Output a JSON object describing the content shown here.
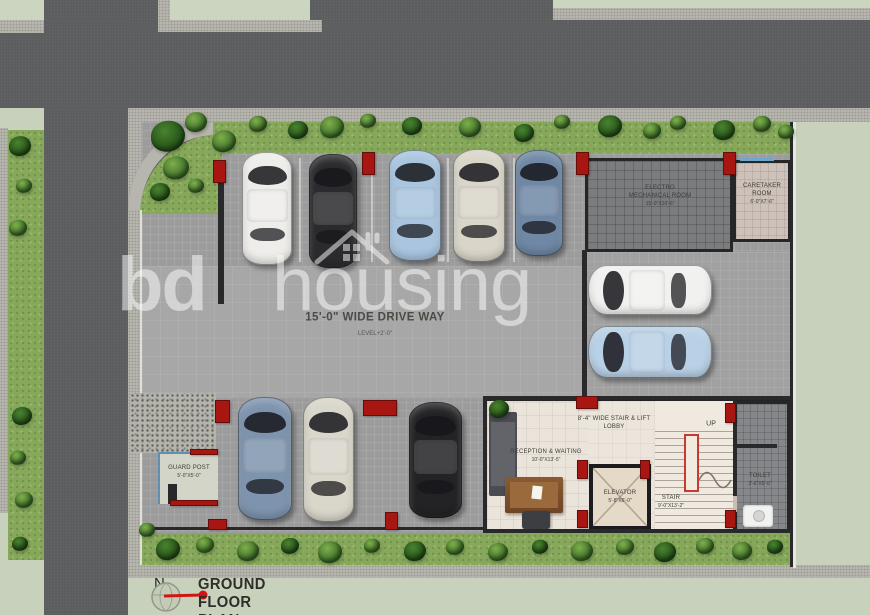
{
  "watermark": {
    "bold": "bd",
    "light": "housing"
  },
  "title_block": {
    "north_letter": "N",
    "title": "GROUND FLOOR PLAN"
  },
  "labels": {
    "driveway": "15'-0\" WIDE DRIVE WAY",
    "driveway_level": "LEVEL+2'-0\"",
    "mech_room": {
      "l1": "ELECTRO",
      "l2": "MECHANICAL ROOM",
      "dim": "15'-0\"X10'-6\""
    },
    "caretaker": {
      "l1": "CARETAKER",
      "l2": "ROOM",
      "dim": "6'-0\"X7'-6\""
    },
    "lobby": {
      "l1": "8'-4\" WIDE STAIR & LIFT",
      "l2": "LOBBY"
    },
    "reception": {
      "l1": "RECEPTION & WAITING",
      "dim": "10'-0\"X13'-5\""
    },
    "elevator": {
      "l1": "ELEVATOR",
      "dim": "5'-8\"X6'-0\""
    },
    "stair": {
      "l1": "STAIR",
      "dim": "9'-0\"X13'-2\""
    },
    "up": "UP",
    "toilet": {
      "l1": "TOILET",
      "dim": "3'-6\"X5'-6\""
    },
    "guard_post": {
      "l1": "GUARD POST",
      "dim": "5'-0\"X5'-0\""
    }
  },
  "colors": {
    "column_red": "#a81612",
    "road": "#5c5d5e",
    "sidewalk": "#b6b6ae",
    "grass": "#87a85b",
    "parking_floor": "#9c9c9d",
    "lobby_floor": "#ece5db",
    "window_blue": "#6fa8cf",
    "north_red": "#d11511"
  },
  "cars": [
    {
      "x": 242,
      "y": 152,
      "w": 50,
      "h": 113,
      "dir": "up",
      "color": "#eeedea"
    },
    {
      "x": 309,
      "y": 154,
      "w": 48,
      "h": 114,
      "dir": "up",
      "color": "#2b2b2e"
    },
    {
      "x": 389,
      "y": 150,
      "w": 52,
      "h": 111,
      "dir": "up",
      "color": "#a9c5df"
    },
    {
      "x": 453,
      "y": 149,
      "w": 52,
      "h": 113,
      "dir": "up",
      "color": "#d9d5c9"
    },
    {
      "x": 515,
      "y": 150,
      "w": 48,
      "h": 106,
      "dir": "up",
      "color": "#6f88a5"
    },
    {
      "x": 588,
      "y": 265,
      "w": 124,
      "h": 50,
      "dir": "left",
      "color": "#f1f1ef"
    },
    {
      "x": 588,
      "y": 326,
      "w": 124,
      "h": 52,
      "dir": "left",
      "color": "#b9d1e6"
    },
    {
      "x": 238,
      "y": 397,
      "w": 54,
      "h": 123,
      "dir": "up",
      "color": "#7e94ae"
    },
    {
      "x": 303,
      "y": 397,
      "w": 51,
      "h": 125,
      "dir": "up",
      "color": "#d9d6ca"
    },
    {
      "x": 409,
      "y": 402,
      "w": 53,
      "h": 116,
      "dir": "up",
      "color": "#232326"
    }
  ],
  "columns": [
    [
      213,
      160,
      13,
      23
    ],
    [
      362,
      152,
      13,
      23
    ],
    [
      576,
      152,
      13,
      23
    ],
    [
      723,
      152,
      13,
      23
    ],
    [
      215,
      400,
      15,
      23
    ],
    [
      363,
      400,
      34,
      16
    ],
    [
      208,
      519,
      19,
      11
    ],
    [
      385,
      512,
      13,
      18
    ],
    [
      576,
      396,
      22,
      13
    ],
    [
      725,
      403,
      11,
      20
    ],
    [
      577,
      460,
      11,
      19
    ],
    [
      640,
      460,
      10,
      19
    ],
    [
      577,
      510,
      11,
      18
    ],
    [
      725,
      510,
      11,
      18
    ],
    [
      190,
      449,
      28,
      6
    ],
    [
      170,
      500,
      48,
      6
    ]
  ],
  "walls": [
    [
      218,
      164,
      6,
      140
    ],
    [
      582,
      250,
      5,
      148
    ],
    [
      483,
      396,
      310,
      4
    ],
    [
      483,
      396,
      4,
      136
    ],
    [
      483,
      529,
      310,
      4
    ],
    [
      733,
      399,
      4,
      133
    ],
    [
      733,
      444,
      44,
      4
    ],
    [
      790,
      122,
      3,
      445
    ],
    [
      168,
      484,
      9,
      20
    ],
    [
      142,
      527,
      344,
      3
    ]
  ],
  "bushes": [
    [
      168,
      136,
      17,
      1
    ],
    [
      196,
      122,
      11,
      0
    ],
    [
      224,
      141,
      12,
      0
    ],
    [
      258,
      124,
      9,
      0
    ],
    [
      298,
      130,
      10,
      1
    ],
    [
      332,
      127,
      12,
      0
    ],
    [
      368,
      121,
      8,
      0
    ],
    [
      412,
      126,
      10,
      1
    ],
    [
      470,
      127,
      11,
      0
    ],
    [
      524,
      133,
      10,
      1
    ],
    [
      562,
      122,
      8,
      0
    ],
    [
      610,
      126,
      12,
      1
    ],
    [
      652,
      131,
      9,
      0
    ],
    [
      678,
      123,
      8,
      0
    ],
    [
      724,
      130,
      11,
      1
    ],
    [
      762,
      124,
      9,
      0
    ],
    [
      786,
      132,
      8,
      0
    ],
    [
      176,
      168,
      13,
      0
    ],
    [
      160,
      192,
      10,
      1
    ],
    [
      196,
      186,
      8,
      0
    ],
    [
      20,
      146,
      11,
      1
    ],
    [
      24,
      186,
      8,
      0
    ],
    [
      18,
      228,
      9,
      0
    ],
    [
      22,
      416,
      10,
      1
    ],
    [
      18,
      458,
      8,
      0
    ],
    [
      24,
      500,
      9,
      0
    ],
    [
      20,
      544,
      8,
      1
    ],
    [
      168,
      549,
      12,
      1
    ],
    [
      205,
      545,
      9,
      0
    ],
    [
      248,
      551,
      11,
      0
    ],
    [
      290,
      546,
      9,
      1
    ],
    [
      330,
      552,
      12,
      0
    ],
    [
      372,
      546,
      8,
      0
    ],
    [
      415,
      551,
      11,
      1
    ],
    [
      455,
      547,
      9,
      0
    ],
    [
      498,
      552,
      10,
      0
    ],
    [
      540,
      547,
      8,
      1
    ],
    [
      582,
      551,
      11,
      0
    ],
    [
      625,
      547,
      9,
      0
    ],
    [
      665,
      552,
      11,
      1
    ],
    [
      705,
      546,
      9,
      0
    ],
    [
      742,
      551,
      10,
      0
    ],
    [
      775,
      547,
      8,
      1
    ],
    [
      499,
      409,
      10,
      1
    ],
    [
      147,
      530,
      8,
      0
    ]
  ]
}
